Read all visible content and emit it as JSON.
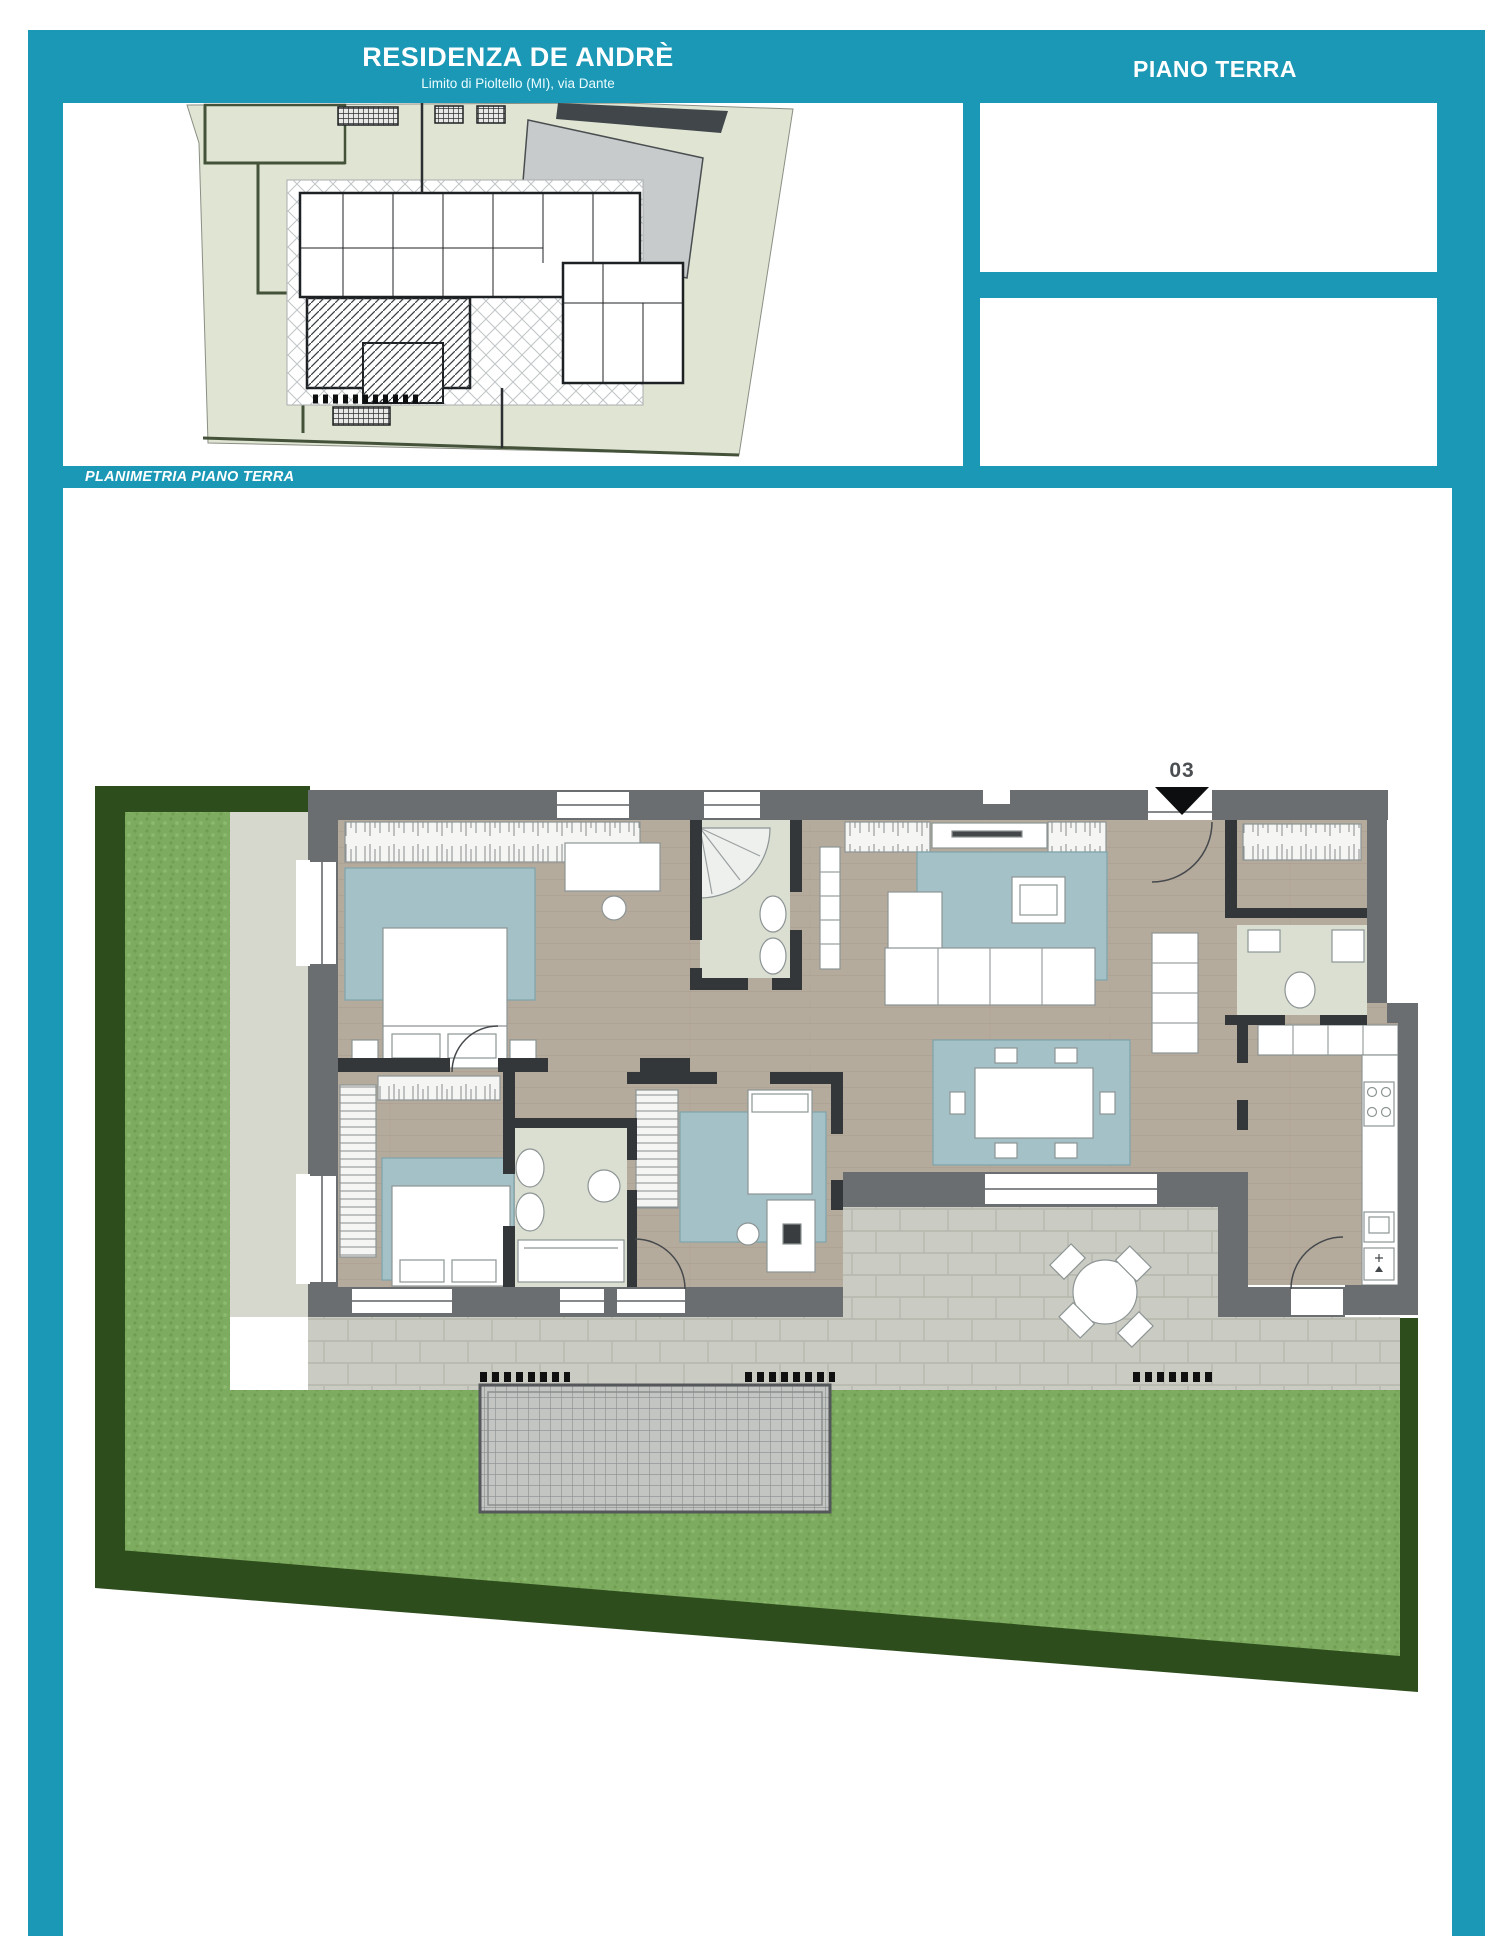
{
  "header": {
    "title": "RESIDENZA DE ANDRÈ",
    "subtitle": "Limito di Pioltello (MI), via Dante",
    "floor_label": "PIANO TERRA"
  },
  "plan_section": {
    "bar_label": "PLANIMETRIA PIANO TERRA"
  },
  "floor_plan": {
    "unit_marker": "03",
    "entrance_icon": "triangle-down-icon"
  },
  "colors": {
    "accent_teal": "#1a98b6",
    "wall_gray": "#6a6e71",
    "grass_green": "#7dab5f",
    "hedge_green": "#2e4d1d",
    "rug_teal": "#a3c1c7",
    "wood_floor": "#b5ab9d",
    "bath_floor": "#dadfd2",
    "patio_stone": "#caccc3",
    "site_land": "#dfe4d3"
  }
}
